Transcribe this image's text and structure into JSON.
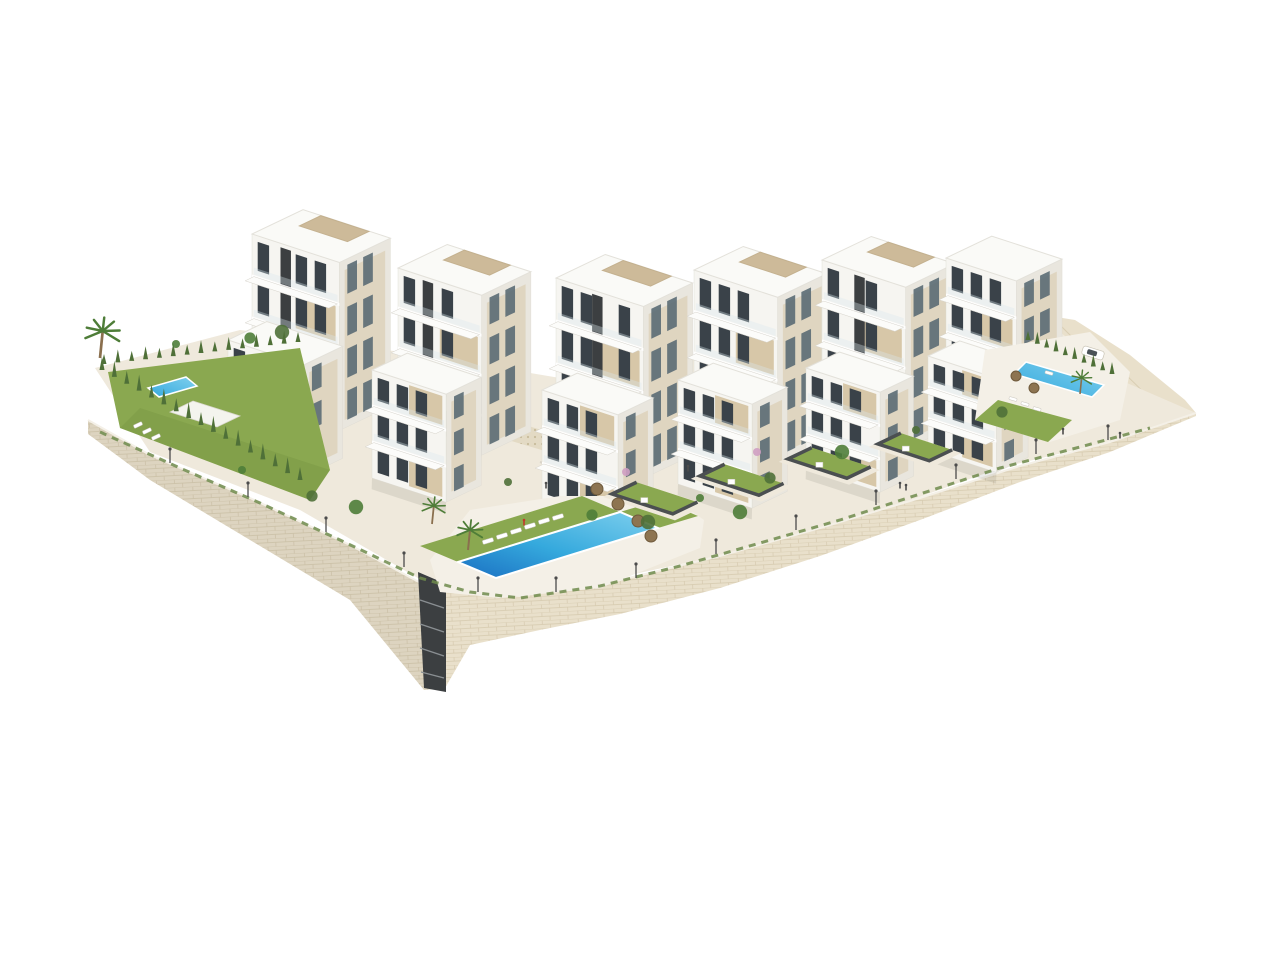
{
  "meta": {
    "description": "Aerial 3D architectural rendering of a modern white apartment complex built on a terraced hillside, with beige stone retaining walls, landscaped lawns, cypress hedges, palm trees, sun loungers, parasols and three blue swimming pools, isolated on a plain white background.",
    "background": "#ffffff"
  },
  "palette": {
    "bg": "#ffffff",
    "faceFront": "#f6f5f1",
    "faceSide": "#e9e6de",
    "roof": "#fafaf7",
    "roofEdge": "#e3e1da",
    "glass": "#3a4249",
    "glassLight": "#5b6b74",
    "tan": "#d7c7a8",
    "tanDark": "#c2ae8a",
    "pergola": "#cbb795",
    "slot": "#3c3f41",
    "stone": "#e9e0cb",
    "stoneLine": "#cfc1a4",
    "paving": "#efe9dc",
    "pavingLight": "#f4f0e7",
    "lawn": "#8aa850",
    "lawnDark": "#74923f",
    "hedge": "#4f7038",
    "hedgeLight": "#6f8b4c",
    "palmGreen": "#4e7d38",
    "trunk": "#8a6f4e",
    "poolDeep": "#1a6fc2",
    "pool": "#35a9dd",
    "poolLight": "#7fd0ee",
    "umbrella": "#8d7451",
    "umbrellaEdge": "#6f5a3c",
    "wallCap": "#4b4f51",
    "lamp": "#4c4c4c",
    "pink": "#cf9ec2",
    "red": "#c0392b",
    "white": "#ffffff",
    "mosaicBg": "#e3dac4",
    "mosaicDot": "#c8bb9b",
    "carGlass": "#4a5258"
  },
  "scene": {
    "buildings": [
      {
        "id": "block-1-rear",
        "x": 252,
        "y": 402,
        "w": 92,
        "h": 168,
        "d": 58,
        "stories": 4,
        "slot": 30,
        "pergola": true,
        "tan": true
      },
      {
        "id": "block-2-rear",
        "x": 398,
        "y": 428,
        "w": 88,
        "h": 160,
        "d": 56,
        "stories": 4,
        "slot": 26,
        "pergola": true,
        "tan": true
      },
      {
        "id": "block-3-rear",
        "x": 556,
        "y": 450,
        "w": 92,
        "h": 172,
        "d": 56,
        "stories": 4,
        "slot": 38,
        "pergola": true,
        "tan": true
      },
      {
        "id": "block-4-rear",
        "x": 694,
        "y": 436,
        "w": 88,
        "h": 166,
        "d": 56,
        "stories": 4,
        "slot": null,
        "pergola": true,
        "tan": true
      },
      {
        "id": "block-5-rear",
        "x": 822,
        "y": 422,
        "w": 88,
        "h": 162,
        "d": 56,
        "stories": 4,
        "slot": 34,
        "pergola": true,
        "tan": true
      },
      {
        "id": "block-6-rear",
        "x": 946,
        "y": 406,
        "w": 74,
        "h": 148,
        "d": 52,
        "stories": 4,
        "slot": null,
        "pergola": false,
        "tan": true
      },
      {
        "id": "block-1-front",
        "x": 228,
        "y": 452,
        "w": 80,
        "h": 112,
        "d": 44,
        "stories": 3,
        "slot": null,
        "pergola": false,
        "tan": true
      },
      {
        "id": "block-2-front",
        "x": 372,
        "y": 478,
        "w": 78,
        "h": 108,
        "d": 40,
        "stories": 3,
        "slot": null,
        "pergola": false,
        "tan": true
      },
      {
        "id": "block-3-front",
        "x": 542,
        "y": 500,
        "w": 80,
        "h": 110,
        "d": 40,
        "stories": 3,
        "slot": null,
        "pergola": false,
        "tan": true
      },
      {
        "id": "block-4-front",
        "x": 678,
        "y": 484,
        "w": 78,
        "h": 104,
        "d": 40,
        "stories": 3,
        "slot": null,
        "pergola": false,
        "tan": true
      },
      {
        "id": "block-5-front",
        "x": 806,
        "y": 468,
        "w": 78,
        "h": 100,
        "d": 38,
        "stories": 3,
        "slot": null,
        "pergola": false,
        "tan": true
      },
      {
        "id": "block-6-front",
        "x": 928,
        "y": 450,
        "w": 72,
        "h": 94,
        "d": 36,
        "stories": 3,
        "slot": null,
        "pergola": false,
        "tan": true
      }
    ],
    "pools": {
      "left": [
        [
          148,
          388
        ],
        [
          186,
          377
        ],
        [
          197,
          386
        ],
        [
          159,
          397
        ]
      ],
      "main": [
        [
          458,
          562
        ],
        [
          620,
          512
        ],
        [
          658,
          528
        ],
        [
          496,
          578
        ]
      ],
      "right": [
        [
          1026,
          362
        ],
        [
          1104,
          385
        ],
        [
          1092,
          397
        ],
        [
          1014,
          374
        ]
      ]
    },
    "gardens": [
      {
        "o": [
          612,
          494
        ],
        "la": 64,
        "lb": 28
      },
      {
        "o": [
          700,
          476
        ],
        "la": 62,
        "lb": 28
      },
      {
        "o": [
          788,
          459
        ],
        "la": 62,
        "lb": 27
      },
      {
        "o": [
          878,
          444
        ],
        "la": 54,
        "lb": 26
      }
    ],
    "hedges": [
      {
        "p1": [
          102,
          370
        ],
        "p2": [
          300,
          480
        ],
        "n": 17,
        "s": 13
      },
      {
        "p1": [
          104,
          364
        ],
        "p2": [
          298,
          342
        ],
        "n": 15,
        "s": 10
      },
      {
        "p1": [
          1028,
          340
        ],
        "p2": [
          1112,
          374
        ],
        "n": 10,
        "s": 9
      }
    ],
    "palms": [
      {
        "x": 100,
        "y": 358,
        "s": 1.35
      },
      {
        "x": 432,
        "y": 524,
        "s": 0.9
      },
      {
        "x": 468,
        "y": 550,
        "s": 1.0
      },
      {
        "x": 1080,
        "y": 394,
        "s": 0.8
      }
    ],
    "loungers": {
      "main": {
        "pts": [
          [
            488,
            541
          ],
          [
            502,
            536
          ],
          [
            516,
            531
          ],
          [
            530,
            526
          ],
          [
            544,
            521
          ],
          [
            558,
            517
          ]
        ],
        "rot": -17,
        "w": 11,
        "h": 4
      },
      "left": {
        "pts": [
          [
            138,
            425
          ],
          [
            147,
            431
          ],
          [
            156,
            437
          ]
        ],
        "rot": -25,
        "w": 9,
        "h": 3.5
      },
      "right": {
        "pts": [
          [
            1013,
            399
          ],
          [
            1025,
            404
          ],
          [
            1037,
            409
          ],
          [
            1049,
            373
          ]
        ],
        "rot": 16,
        "w": 8,
        "h": 3
      }
    },
    "umbrellas": {
      "main": {
        "pts": [
          [
            597,
            489
          ],
          [
            618,
            504
          ],
          [
            638,
            521
          ],
          [
            651,
            536
          ]
        ],
        "r": 6
      },
      "right": {
        "pts": [
          [
            1016,
            376
          ],
          [
            1034,
            388
          ]
        ],
        "r": 5
      }
    },
    "lamps": [
      [
        170,
        463
      ],
      [
        248,
        497
      ],
      [
        326,
        532
      ],
      [
        404,
        567
      ],
      [
        478,
        592
      ],
      [
        556,
        592
      ],
      [
        636,
        578
      ],
      [
        716,
        554
      ],
      [
        796,
        530
      ],
      [
        876,
        505
      ],
      [
        956,
        479
      ],
      [
        1036,
        454
      ],
      [
        1108,
        440
      ]
    ],
    "people": [
      {
        "p": [
          546,
          487
        ],
        "c": "lamp"
      },
      {
        "p": [
          688,
          470
        ],
        "c": "lamp"
      },
      {
        "p": [
          900,
          487
        ],
        "c": "lamp"
      },
      {
        "p": [
          906,
          489
        ],
        "c": "lamp"
      },
      {
        "p": [
          1063,
          433
        ],
        "c": "lamp"
      },
      {
        "p": [
          1120,
          437
        ],
        "c": "lamp"
      },
      {
        "p": [
          524,
          524
        ],
        "c": "red"
      }
    ],
    "shrubs_green": [
      [
        242,
        470
      ],
      [
        312,
        496
      ],
      [
        356,
        507
      ],
      [
        508,
        482
      ],
      [
        592,
        515
      ],
      [
        648,
        522
      ],
      [
        700,
        498
      ],
      [
        770,
        478
      ],
      [
        842,
        452
      ],
      [
        916,
        430
      ],
      [
        250,
        338
      ],
      [
        282,
        332
      ],
      [
        176,
        344
      ],
      [
        1002,
        412
      ],
      [
        740,
        512
      ]
    ],
    "shrubs_pink": [
      [
        757,
        452
      ],
      [
        626,
        472
      ]
    ],
    "car": {
      "cx": 1093,
      "cy": 353,
      "angle": 17
    },
    "greenery_trail": "100,432 180,468 260,503 340,540 420,578 470,592 520,598 600,586 680,566 760,543 840,520 920,494 1000,468 1080,447 1150,428"
  }
}
